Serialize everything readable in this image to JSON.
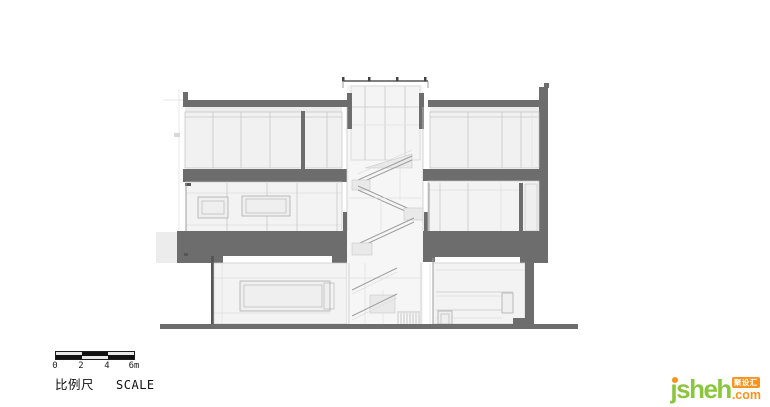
{
  "page": {
    "background": "#ffffff"
  },
  "drawing": {
    "type": "architectural-section",
    "description": "Building cross-section: three levels around a central stair atrium with roof skylight",
    "colors": {
      "slab": "#6d6d6d",
      "wall_fill": "#f1f1f1",
      "line": "#c8c8c8",
      "ground": "#6d6d6d"
    }
  },
  "scale_bar": {
    "ticks": [
      "0",
      "2",
      "4",
      "6m"
    ],
    "label_cn": "比例尺",
    "label_en": "SCALE"
  },
  "logo": {
    "brand": "jsheh",
    "tld": ".com",
    "badge": "聚设汇",
    "colors": {
      "green": "#8cc63e",
      "orange": "#f7941d"
    }
  }
}
